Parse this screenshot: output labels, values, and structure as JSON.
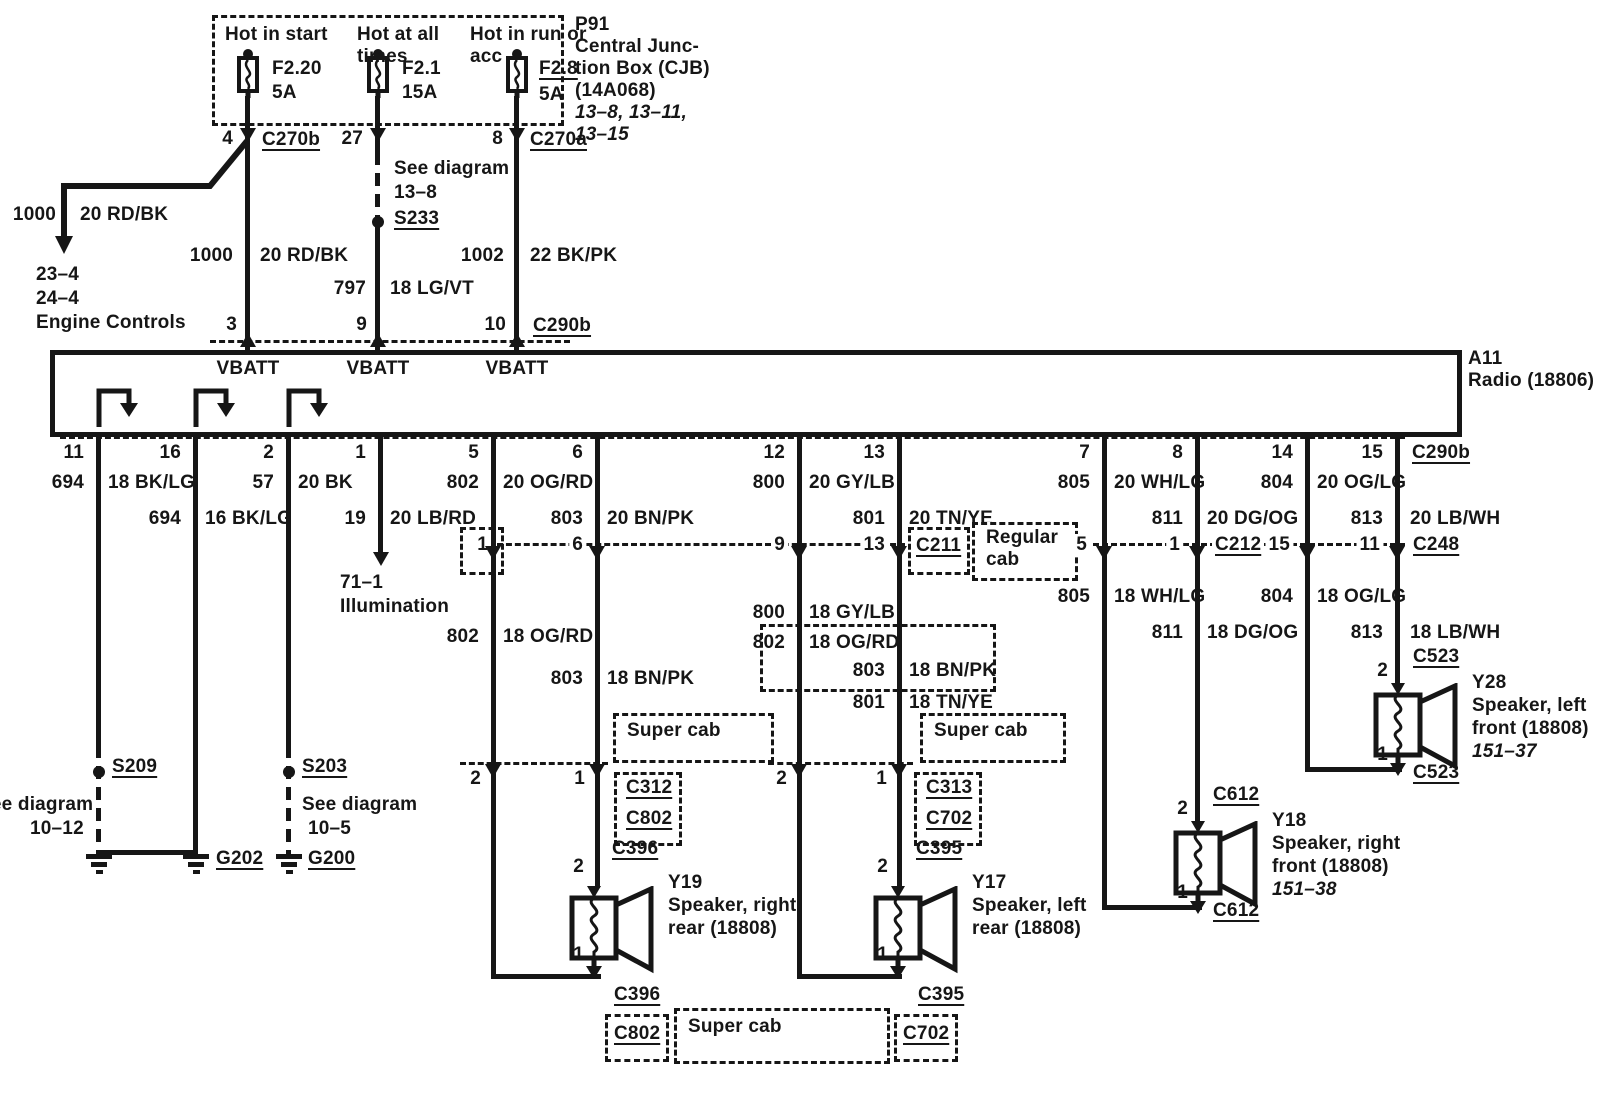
{
  "d": {
    "cjb": {
      "id": "P91",
      "n1": "Central Junc-",
      "n2": "tion Box (CJB)",
      "n3": "(14A068)",
      "r1": "13–8, 13–11,",
      "r2": "13–15",
      "f1": {
        "h1": "Hot in start",
        "name": "F2.20",
        "amps": "5A",
        "pin": "4",
        "conn": "C270b"
      },
      "f2": {
        "h1": "Hot at all",
        "h2": "times",
        "name": "F2.1",
        "amps": "15A",
        "pin": "27"
      },
      "f3": {
        "h1": "Hot in run or",
        "h2": "acc",
        "name": "F2.8",
        "amps": "5A",
        "pin": "8",
        "conn": "C270a"
      }
    },
    "branch": {
      "c": "1000",
      "col": "20 RD/BK",
      "r1": "23–4",
      "r2": "24–4",
      "dest": "Engine Controls"
    },
    "feed1": {
      "c": "1000",
      "col": "20 RD/BK",
      "pin": "3"
    },
    "feed2": {
      "s1": "See diagram",
      "s2": "13–8",
      "sp": "S233",
      "c": "797",
      "col": "18 LG/VT",
      "pin": "9"
    },
    "feed3": {
      "c": "1002",
      "col": "22 BK/PK",
      "pin": "10",
      "conn": "C290b"
    },
    "vbatt": "VBATT",
    "radio": {
      "id": "A11",
      "name": "Radio (18806)",
      "conn": "C290b"
    },
    "w11": {
      "pin": "11",
      "c": "694",
      "col": "18 BK/LG",
      "sp": "S209",
      "s1": "See diagram",
      "s2": "10–12"
    },
    "w16": {
      "pin": "16",
      "c": "694",
      "col": "16 BK/LG",
      "gnd": "G202"
    },
    "w02": {
      "pin": "2",
      "c": "57",
      "col": "20 BK",
      "sp": "S203",
      "s1": "See diagram",
      "s2": "10–5",
      "gnd": "G200"
    },
    "w01": {
      "pin": "1",
      "c": "19",
      "col": "20 LB/RD",
      "d1": "71–1",
      "d2": "Illumination"
    },
    "w05": {
      "pin": "5",
      "c1": "802",
      "col1": "20 OG/RD",
      "x1": "1",
      "c2": "802",
      "col2": "18 OG/RD",
      "x2": "2"
    },
    "w06": {
      "pin": "6",
      "c1": "803",
      "col1": "20 BN/PK",
      "x1": "6",
      "c2": "803",
      "col2": "18 BN/PK",
      "x2": "1"
    },
    "w12": {
      "pin": "12",
      "c1": "800",
      "col1": "20 GY/LB",
      "x1": "9",
      "c2": "800",
      "col2": "18 GY/LB",
      "c3": "802",
      "col3": "18 OG/RD",
      "x2": "2"
    },
    "w13": {
      "pin": "13",
      "c1": "801",
      "col1": "20 TN/YE",
      "x1": "13",
      "conn": "C211",
      "c3": "803",
      "col3": "18 BN/PK",
      "c2": "801",
      "col2": "18 TN/YE",
      "x2": "1"
    },
    "w07": {
      "pin": "7",
      "c1": "805",
      "col1": "20 WH/LG",
      "x1": "5",
      "c2": "805",
      "col2": "18 WH/LG"
    },
    "w08": {
      "pin": "8",
      "c1": "811",
      "col1": "20 DG/OG",
      "x1": "1",
      "conn": "C212",
      "c2": "811",
      "col2": "18 DG/OG"
    },
    "w14": {
      "pin": "14",
      "c1": "804",
      "col1": "20 OG/LG",
      "x1": "15",
      "c2": "804",
      "col2": "18 OG/LG"
    },
    "w15": {
      "pin": "15",
      "conn0": "C290b",
      "c1": "813",
      "col1": "20 LB/WH",
      "x1": "11",
      "conn": "C248",
      "c2": "813",
      "col2": "18 LB/WH"
    },
    "cab": {
      "reg1": "Regular",
      "reg2": "cab",
      "sup": "Super cab"
    },
    "cx": {
      "c312": "C312",
      "c802": "C802",
      "c313": "C313",
      "c702": "C702"
    },
    "y19": {
      "id": "Y19",
      "l1": "Speaker, right",
      "l2": "rear (18808)",
      "conn": "C396",
      "p2": "2",
      "p1": "1"
    },
    "y17": {
      "id": "Y17",
      "l1": "Speaker, left",
      "l2": "rear (18808)",
      "conn": "C395",
      "p2": "2",
      "p1": "1"
    },
    "y18": {
      "id": "Y18",
      "l1": "Speaker, right",
      "l2": "front (18808)",
      "ref": "151–38",
      "conn": "C612",
      "p2": "2",
      "p1": "1"
    },
    "y28": {
      "id": "Y28",
      "l1": "Speaker, left",
      "l2": "front (18808)",
      "ref": "151–37",
      "conn": "C523",
      "p2": "2",
      "p1": "1"
    }
  }
}
